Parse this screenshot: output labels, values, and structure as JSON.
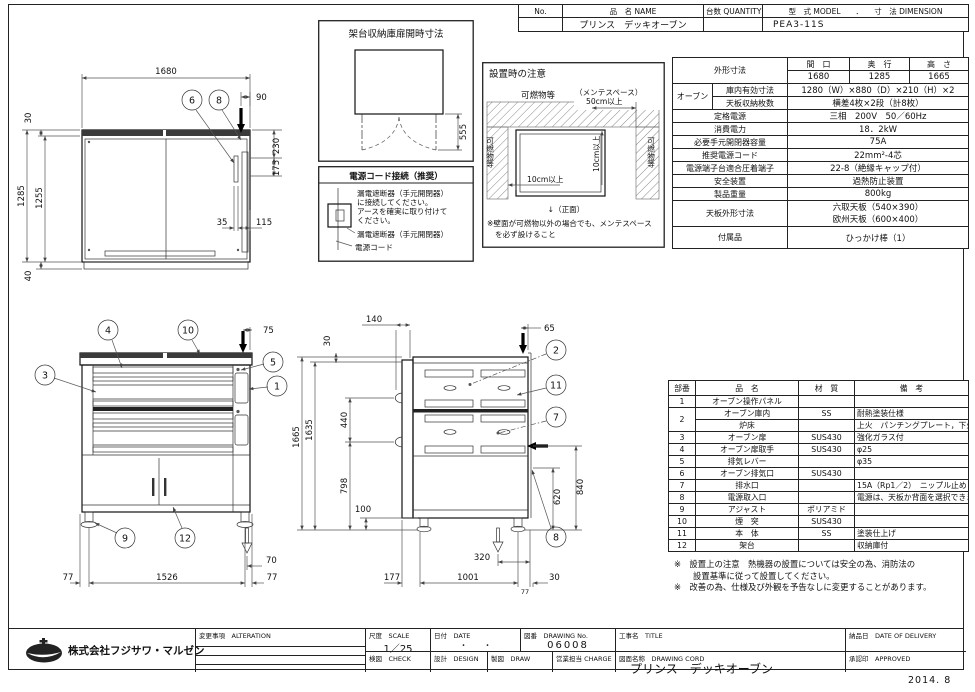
{
  "head": {
    "no": "No.",
    "name": "品　名 NAME",
    "qty": "台数 QUANTITY",
    "model": "型　式 MODEL　　．　　寸　法 DIMENSION",
    "name_v": "プリンス　デッキオーブン",
    "model_v": "PEA3-11S"
  },
  "spec": {
    "outer_label": "外形寸法",
    "w_h": "間　口",
    "d_h": "奥　行",
    "h_h": "高　さ",
    "w": "1680",
    "d": "1285",
    "h": "1665",
    "oven": "オーブン",
    "inner_label": "庫内有効寸法",
    "inner": "1280（W）×880（D）×210（H）×2",
    "tray_label": "天板収納枚数",
    "tray": "横差4枚×2段（計8枚）",
    "rated_label": "定格電源",
    "rated": "三相　200V　50／60Hz",
    "cons_label": "消費電力",
    "cons": "18．2kW",
    "breaker_label": "必要手元開閉器容量",
    "breaker": "75A",
    "cord_label": "推奨電源コード",
    "cord": "22mm²-4芯",
    "term_label": "電源端子台適合圧着端子",
    "term": "22-8（絶縁キャップ付）",
    "safety_label": "安全装置",
    "safety": "過熱防止装置",
    "weight_label": "製品重量",
    "weight": "800kg",
    "tray_dim_label": "天板外形寸法",
    "tray_dim1": "六取天板（540×390）",
    "tray_dim2": "欧州天板（600×400）",
    "acc_label": "付属品",
    "acc": "ひっかけ棒（1）"
  },
  "parts": {
    "h_no": "部番",
    "h_name": "品　名",
    "h_mat": "材　質",
    "h_note": "備　考",
    "rows": [
      {
        "no": "1",
        "name": "オーブン操作パネル",
        "mat": "",
        "note": ""
      },
      {
        "no": "2",
        "name": "オーブン庫内",
        "mat": "SS",
        "note": "耐熱塗装仕様"
      },
      {
        "no": "",
        "name": "炉床",
        "mat": "",
        "note": "上火　パンチングプレート，下火　SS"
      },
      {
        "no": "3",
        "name": "オーブン扉",
        "mat": "SUS430",
        "note": "強化ガラス付"
      },
      {
        "no": "4",
        "name": "オーブン扉取手",
        "mat": "SUS430",
        "note": "φ25"
      },
      {
        "no": "5",
        "name": "排気レバー",
        "mat": "",
        "note": "φ35"
      },
      {
        "no": "6",
        "name": "オーブン排気口",
        "mat": "SUS430",
        "note": ""
      },
      {
        "no": "7",
        "name": "排水口",
        "mat": "",
        "note": "15A（Rp1／2）　ニップル止め"
      },
      {
        "no": "8",
        "name": "電源取入口",
        "mat": "",
        "note": "電源は、天板か背面を選択できます"
      },
      {
        "no": "9",
        "name": "アジャスト",
        "mat": "ポリアミド",
        "note": ""
      },
      {
        "no": "10",
        "name": "煙　突",
        "mat": "SUS430",
        "note": ""
      },
      {
        "no": "11",
        "name": "本　体",
        "mat": "SS",
        "note": "塗装仕上げ"
      },
      {
        "no": "12",
        "name": "架台",
        "mat": "",
        "note": "収納庫付"
      }
    ]
  },
  "notes": {
    "n1": "※　設置上の注意　熱機器の設置については安全の為、消防法の",
    "n2": "設置基準に従って設置してください。",
    "n3": "※　改善の為、仕様及び外観を予告なしに変更することがあります。"
  },
  "install": {
    "title": "設置時の注意",
    "top": "可燃物等",
    "left": "可燃物等",
    "right": "可燃物等",
    "mente": "（メンテスペース）",
    "d50": "50cm以上",
    "d10h": "10cm以上",
    "d10v": "10cm以上",
    "front": "↓（正面）",
    "n1": "※壁面が可燃物以外の場合でも、メンテスペース",
    "n2": "を必ず設けること"
  },
  "rack": {
    "title": "架台収納庫扉開時寸法",
    "d555": "555"
  },
  "power": {
    "title": "電源コード接続（推奨）",
    "l1": "漏電遮断器（手元開閉器）",
    "l2": "に接続してください。",
    "l3": "アースを確実に取り付けて",
    "l4": "ください。",
    "cb": "漏電遮断器（手元開閉器）",
    "cord": "電源コード"
  },
  "tv": {
    "d1680": "1680",
    "d90": "90",
    "d30": "30",
    "d1285": "1285",
    "d1255": "1255",
    "d40": "40",
    "d230": "230",
    "d175": "175",
    "d35": "35",
    "d115": "115",
    "b6": "6",
    "b8": "8"
  },
  "fv": {
    "d75": "75",
    "d70": "70",
    "d77l": "77",
    "d1526": "1526",
    "d77r": "77",
    "b1": "1",
    "b3": "3",
    "b4": "4",
    "b5": "5",
    "b9": "9",
    "b10": "10",
    "b12": "12"
  },
  "sv": {
    "d140": "140",
    "d30": "30",
    "d65": "65",
    "d1665": "1665",
    "d1635": "1635",
    "d440": "440",
    "d798": "798",
    "d100": "100",
    "d840": "840",
    "d620": "620",
    "d320": "320",
    "d177": "177",
    "d1001": "1001",
    "d77": "77",
    "d30b": "30",
    "b2": "2",
    "b7": "7",
    "b8": "8",
    "b11": "11"
  },
  "block": {
    "company": "株式会社フジサワ・マルゼン",
    "alteration_label": "変更事項　ALTERATION",
    "scale_label": "尺度　SCALE",
    "scale_value": "1／25",
    "date_label": "日付　DATE",
    "date_value": "・　　・",
    "check_label": "検図　CHECK",
    "design_label": "設計　DESIGN",
    "drawing_no_label": "図番　DRAWING No.",
    "drawing_no_value": "06008",
    "title_label": "工事名　TITLE",
    "delivery_label": "納品日　DATE OF DELIVERY",
    "draw_label": "製図　DRAW",
    "charge_label": "営業担当 CHARGE",
    "drawing_name_label": "図面名称　DRAWING CORD",
    "drawing_name_value": "プリンス　デッキオーブン",
    "approved_label": "承認印　APPROVED",
    "footer_date": "2014. 8"
  }
}
